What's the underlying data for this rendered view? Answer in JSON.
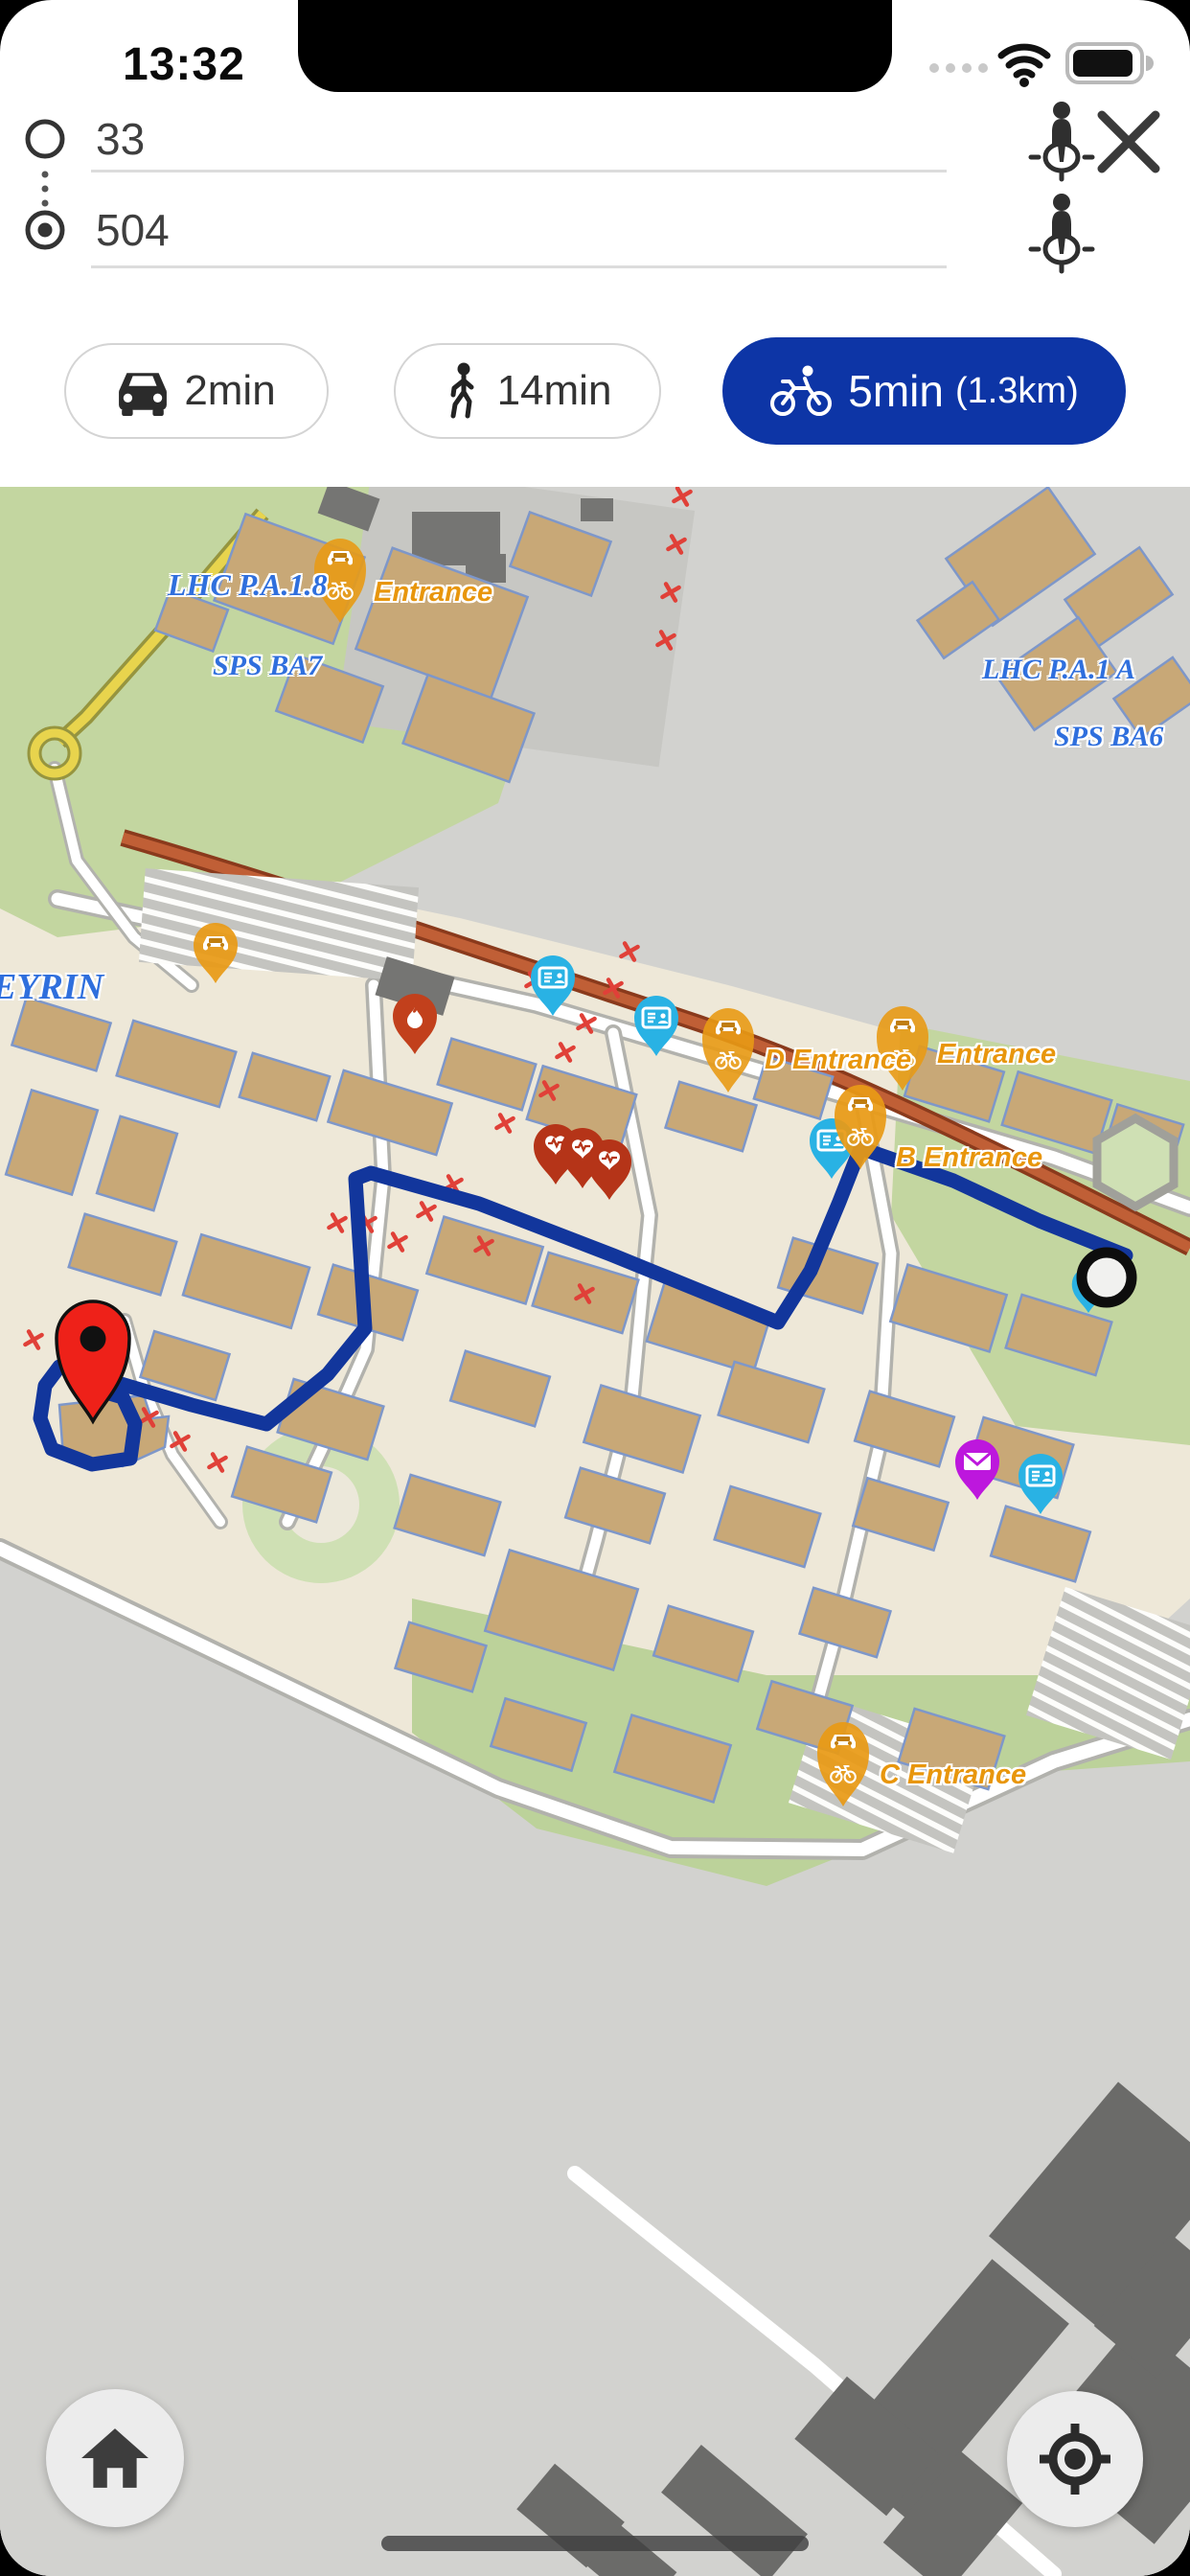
{
  "status_bar": {
    "time": "13:32"
  },
  "route_panel": {
    "origin_value": "33",
    "destination_value": "504"
  },
  "modes": {
    "car_label": "2min",
    "walk_label": "14min",
    "bike_label": "5min",
    "bike_distance": "(1.3km)"
  },
  "map_labels": {
    "lhc_pa18": "LHC P.A.1.8",
    "entrance_top": "Entrance",
    "sps_ba7": "SPS BA7",
    "lhc_pa1": "LHC P.A.1 A",
    "sps_ba6": "SPS BA6",
    "meyrin": "EYRIN",
    "d_entrance": "D Entrance",
    "entrance_right": "Entrance",
    "b_entrance": "B Entrance",
    "c_entrance": "C Entrance"
  },
  "icons": [
    "wifi-icon",
    "battery-icon",
    "cellular-dots-icon",
    "origin-circle-icon",
    "destination-circle-icon",
    "locate-person-icon",
    "close-icon",
    "car-icon",
    "walk-icon",
    "bike-icon",
    "entrance-pin-car-bike",
    "bus-pin-car",
    "badge-pin-card",
    "fire-pin-flame",
    "defibrillator-pin-heart",
    "mail-pin-envelope",
    "destination-pin",
    "route-start-circle",
    "home-icon",
    "locate-crosshair-icon"
  ],
  "colors": {
    "accent_blue": "#0d35a6",
    "route_blue": "#12369c",
    "map_label_blue": "#2f6fdd",
    "entrance_orange": "#e8960c",
    "marker_orange": "#e89a15",
    "marker_cyan": "#29b2e4",
    "marker_purple": "#bd17dd",
    "pin_red": "#ee2119",
    "fire_red": "#c2401c",
    "heart_red": "#b53418"
  }
}
